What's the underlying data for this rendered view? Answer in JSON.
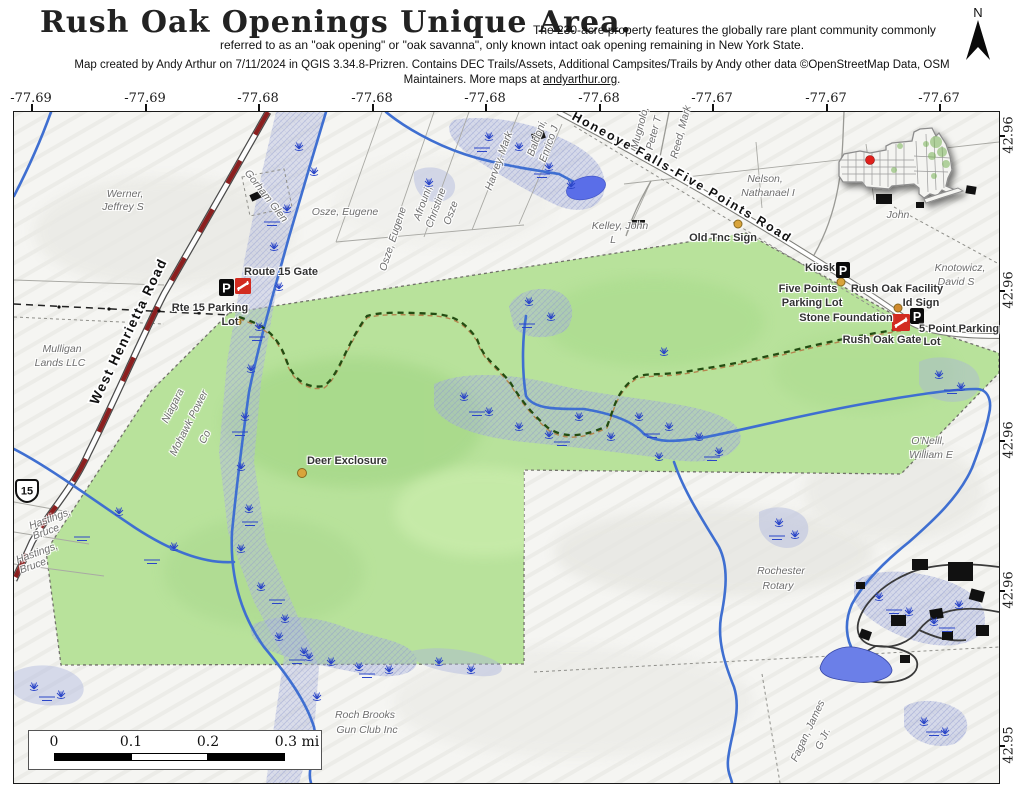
{
  "header": {
    "title": "Rush Oak Openings Unique Area.",
    "subtitle_line1": "The 230-acre property features the globally rare plant community commonly",
    "subtitle_line2": "referred to as an \"oak opening\" or \"oak savanna\", only known intact oak opening remaining in New York State.",
    "credit_line1": "Map created by Andy Arthur on 7/11/2024 in QGIS 3.34.8-Prizren. Contains DEC Trails/Assets, Additional Campsites/Trails by Andy other data ©OpenStreetMap Data, OSM",
    "credit_line2_pre": "Maintainers. More maps at ",
    "credit_link": "andyarthur.org",
    "credit_line2_post": ".",
    "north_label": "N"
  },
  "axes": {
    "top": [
      "-77.69",
      "-77.69",
      "-77.68",
      "-77.68",
      "-77.68",
      "-77.68",
      "-77.67",
      "-77.67",
      "-77.67"
    ],
    "right": [
      "42.96",
      "42.96",
      "42.96",
      "42.96",
      "42.95"
    ]
  },
  "scalebar": {
    "labels": [
      "0",
      "0.1",
      "0.2",
      "0.3 mi"
    ]
  },
  "map": {
    "road_shield": "15",
    "icons": {
      "parking_letter": "P"
    },
    "road_labels": [
      {
        "text": "West Henrietta Road"
      },
      {
        "text": "Honeoye Falls-Five Points Road"
      }
    ],
    "owner_labels": [
      {
        "text": "Werner,"
      },
      {
        "text": "Jeffrey S"
      },
      {
        "text": "Mulligan"
      },
      {
        "text": "Lands LLC"
      },
      {
        "text": "Gorham Glen"
      },
      {
        "text": "Osze, Eugene"
      },
      {
        "text": "Osze, Eugene"
      },
      {
        "text": "Afrouni,"
      },
      {
        "text": "Christine"
      },
      {
        "text": "Osze"
      },
      {
        "text": "Harvey, Mark"
      },
      {
        "text": "Baldoni,"
      },
      {
        "text": "Enrico J"
      },
      {
        "text": "Mugnolo,"
      },
      {
        "text": "Peter T"
      },
      {
        "text": "Reed, Mark"
      },
      {
        "text": "Nelson,"
      },
      {
        "text": "Nathanael I"
      },
      {
        "text": "Kelley, John"
      },
      {
        "text": "L"
      },
      {
        "text": "Knotowicz,"
      },
      {
        "text": "David S"
      },
      {
        "text": "O'Neill,"
      },
      {
        "text": "William E"
      },
      {
        "text": "Rochester"
      },
      {
        "text": "Rotary"
      },
      {
        "text": "Roch Brooks"
      },
      {
        "text": "Gun Club Inc"
      },
      {
        "text": "Fagan, James"
      },
      {
        "text": "G Jr."
      },
      {
        "text": "Hastings,"
      },
      {
        "text": "Bruce"
      },
      {
        "text": "Hastings,"
      },
      {
        "text": "Bruce"
      },
      {
        "text": "Niagara"
      },
      {
        "text": "Mohawk Power"
      },
      {
        "text": "Co"
      },
      {
        "text": "John"
      }
    ],
    "poi_labels": [
      {
        "text": "Route 15 Gate"
      },
      {
        "text": "Rte 15 Parking"
      },
      {
        "text": "Lot"
      },
      {
        "text": "Old Tnc Sign"
      },
      {
        "text": "Kiosk"
      },
      {
        "text": "Five Points"
      },
      {
        "text": "Parking Lot"
      },
      {
        "text": "Rush Oak Facility"
      },
      {
        "text": "Id Sign"
      },
      {
        "text": "Stone Foundation"
      },
      {
        "text": "Rush Oak Gate"
      },
      {
        "text": "5 Point Parking"
      },
      {
        "text": "Lot"
      },
      {
        "text": "Deer Exclosure"
      }
    ],
    "colors": {
      "protected_area_green": "#b8e29b",
      "wetland_lavender": "#aab3dd",
      "stream_blue": "#3f6fd1",
      "pond_blue": "#6b7fe8",
      "route_red": "#8b1f1f",
      "trail_green": "#234d12",
      "trail_tan": "#b5854f",
      "poi_dot_gold": "#d9a43b",
      "gate_icon_red": "#d22b20",
      "inset_marker_red": "#e0201b"
    }
  }
}
